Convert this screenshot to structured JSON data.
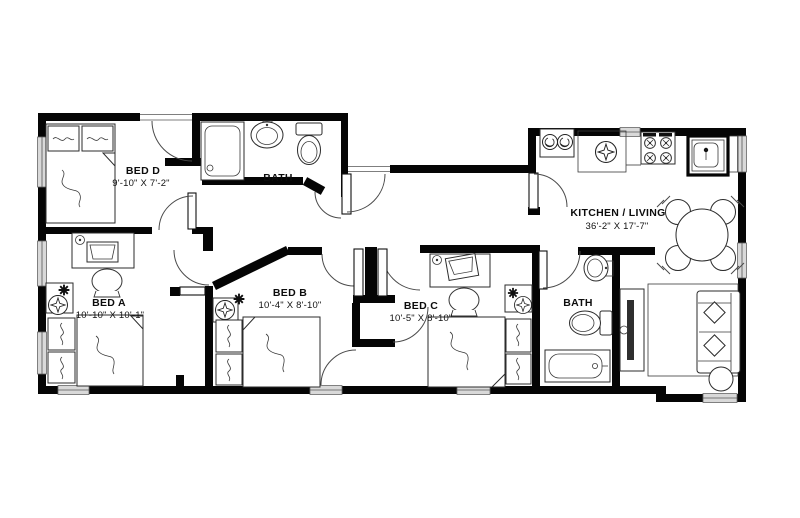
{
  "plan": {
    "background": "#ffffff",
    "wall_color": "#050505",
    "line_color": "#2b2b2b",
    "rooms": {
      "bed_d": {
        "name": "BED D",
        "dims": "9'-10\" X 7'-2\""
      },
      "bath_top": {
        "name": "BATH"
      },
      "bed_a": {
        "name": "BED A",
        "dims": "10'-10\" X 10'-1\""
      },
      "bed_b": {
        "name": "BED B",
        "dims": "10'-4\" X 8'-10\""
      },
      "bed_c": {
        "name": "BED C",
        "dims": "10'-5\" X 8'-10\""
      },
      "bath_right": {
        "name": "BATH"
      },
      "kitchen_living": {
        "name": "KITCHEN / LIVING",
        "dims": "36'-2\" X 17'-7\""
      }
    }
  }
}
